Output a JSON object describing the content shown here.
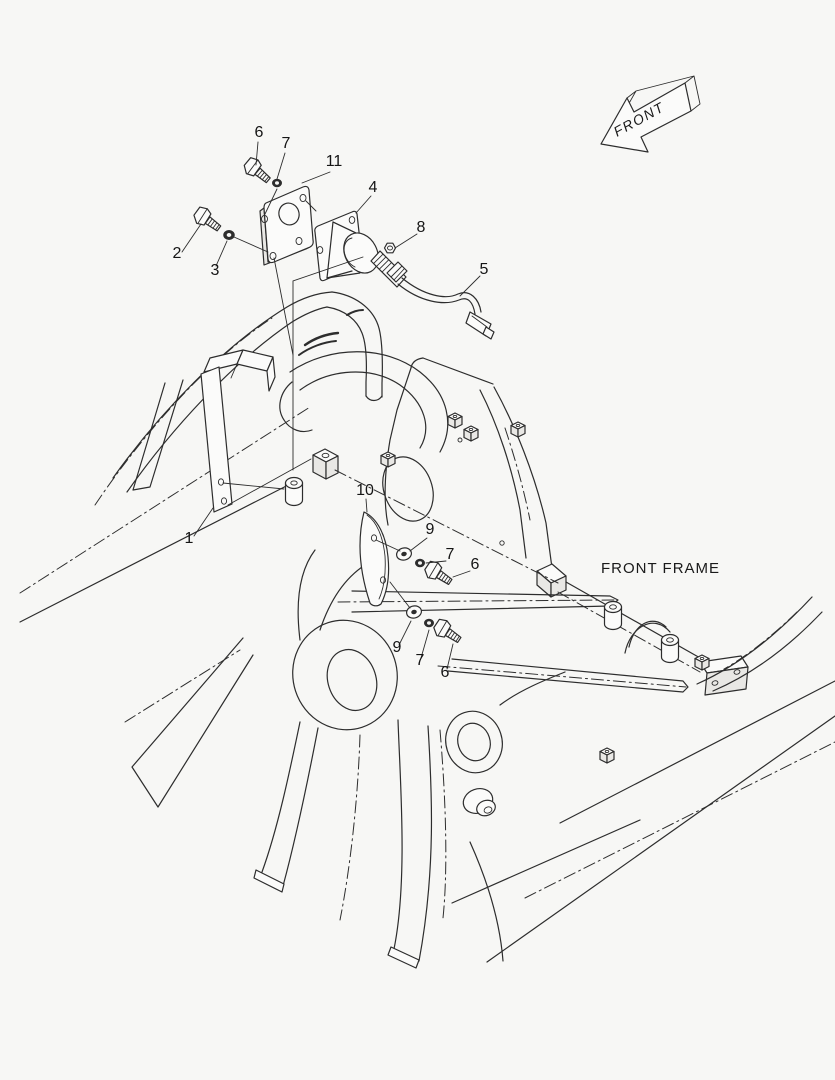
{
  "page": {
    "background_color": "#f7f7f5",
    "line_color": "#2d2d2d"
  },
  "direction_arrow": {
    "label": "FRONT"
  },
  "frame": {
    "label": "FRONT FRAME"
  },
  "callouts": [
    {
      "part": "6",
      "x": 259,
      "y": 137,
      "target": "bolt"
    },
    {
      "part": "7",
      "x": 286,
      "y": 148,
      "target": "spring-washer"
    },
    {
      "part": "11",
      "x": 334,
      "y": 166,
      "target": "mounting-plate"
    },
    {
      "part": "2",
      "x": 177,
      "y": 258,
      "target": "bolt"
    },
    {
      "part": "3",
      "x": 215,
      "y": 275,
      "target": "spring-washer"
    },
    {
      "part": "4",
      "x": 373,
      "y": 192,
      "target": "horn"
    },
    {
      "part": "8",
      "x": 421,
      "y": 232,
      "target": "nut"
    },
    {
      "part": "5",
      "x": 484,
      "y": 274,
      "target": "cable"
    },
    {
      "part": "1",
      "x": 189,
      "y": 543,
      "target": "bracket"
    },
    {
      "part": "10",
      "x": 365,
      "y": 495,
      "target": "guard-plate"
    },
    {
      "part": "9",
      "x": 430,
      "y": 534,
      "target": "plain-washer"
    },
    {
      "part": "7",
      "x": 450,
      "y": 559,
      "target": "spring-washer"
    },
    {
      "part": "6",
      "x": 475,
      "y": 569,
      "target": "bolt"
    },
    {
      "part": "9",
      "x": 397,
      "y": 652,
      "target": "plain-washer"
    },
    {
      "part": "7",
      "x": 420,
      "y": 665,
      "target": "spring-washer"
    },
    {
      "part": "6",
      "x": 445,
      "y": 677,
      "target": "bolt"
    }
  ]
}
